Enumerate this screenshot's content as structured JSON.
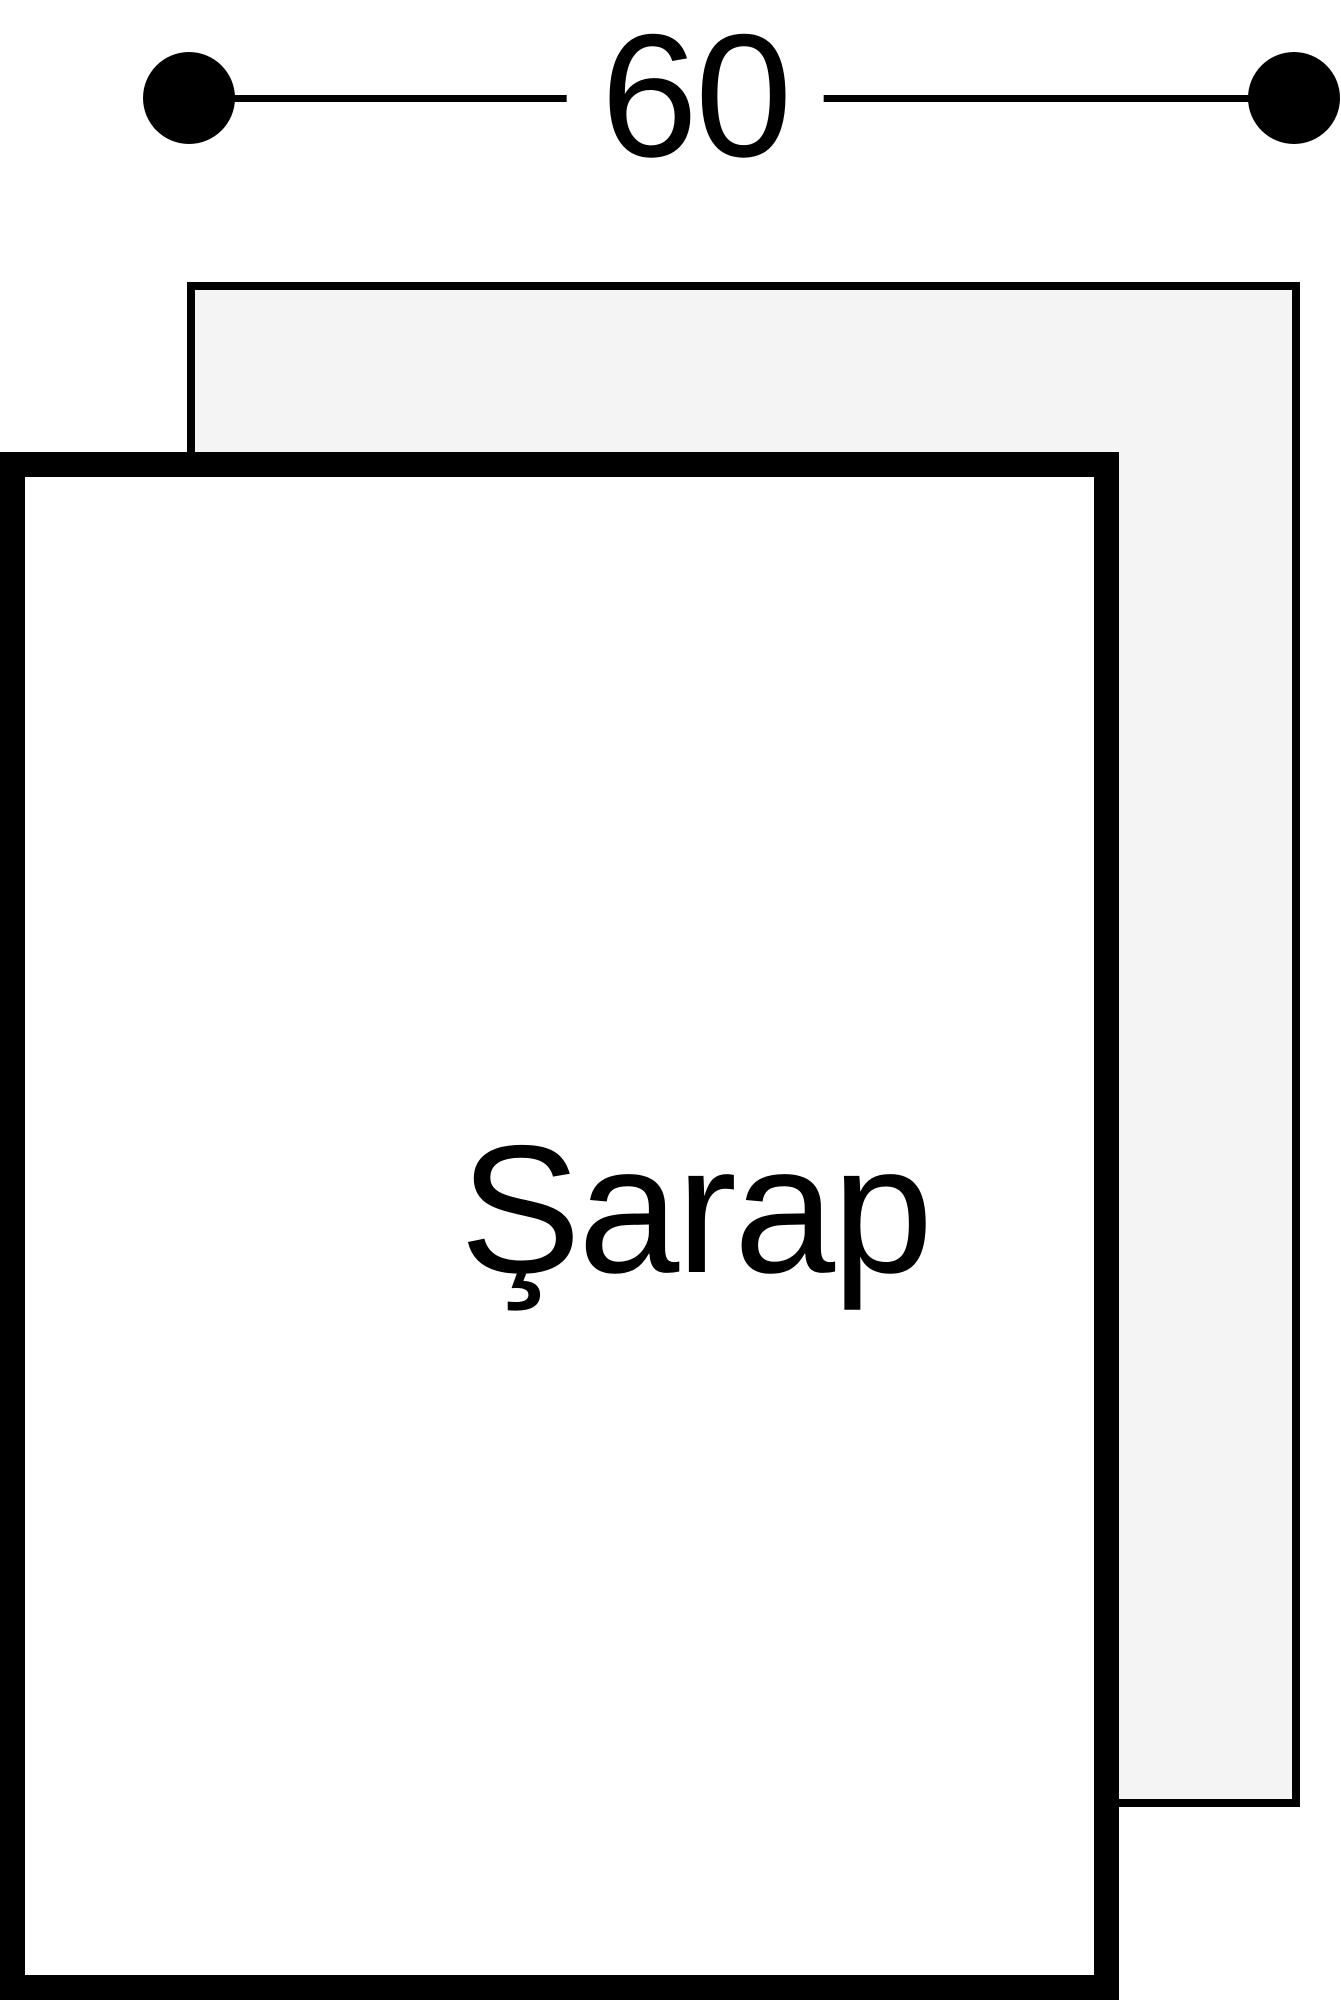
{
  "diagram": {
    "title": "appliance-niche-dimension-diagram",
    "dimension": {
      "value": "60"
    },
    "appliance": {
      "label": "Şarap"
    }
  },
  "colors": {
    "stroke": "#000000",
    "background": "#ffffff",
    "niche_fill": "#f4f4f4",
    "door_fill": "#ffffff",
    "text": "#000000"
  }
}
